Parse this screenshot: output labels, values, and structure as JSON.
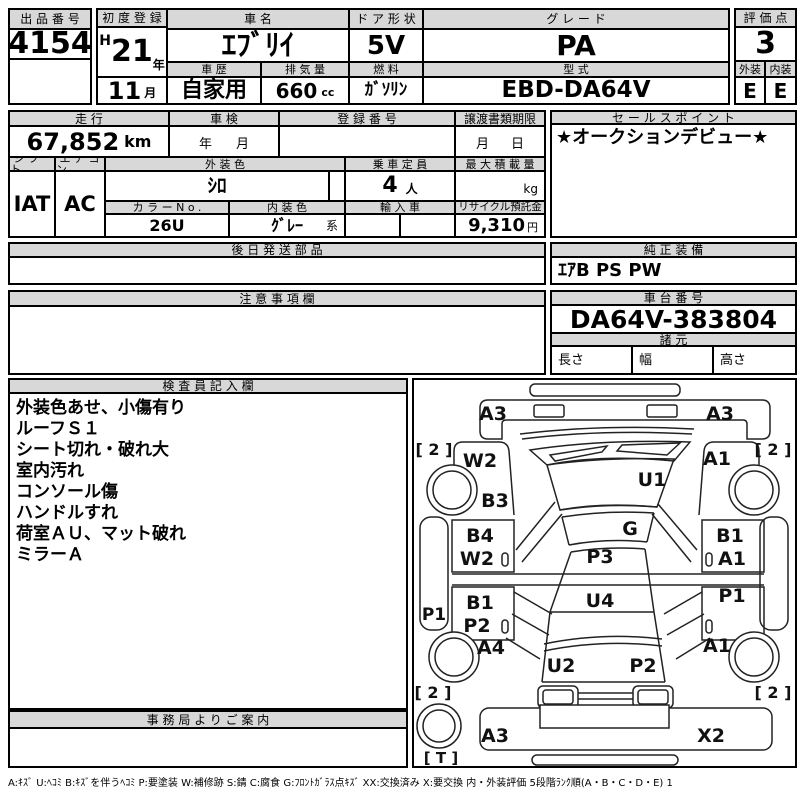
{
  "lot": {
    "label": "出品番号",
    "value": "4154"
  },
  "first_reg": {
    "label": "初度登録",
    "era": "H",
    "year": "21",
    "year_unit": "年",
    "month": "11",
    "month_unit": "月"
  },
  "car_name": {
    "label": "車名",
    "value": "ｴﾌﾞﾘｲ"
  },
  "door": {
    "label": "ドア形状",
    "value": "5V"
  },
  "grade": {
    "label": "グレード",
    "value": "PA"
  },
  "score": {
    "label": "評価点",
    "value": "3",
    "exterior_label": "外装",
    "exterior": "E",
    "interior_label": "内装",
    "interior": "E"
  },
  "history": {
    "label": "車歴",
    "value": "自家用"
  },
  "displacement": {
    "label": "排気量",
    "value": "660",
    "unit": "cc"
  },
  "fuel": {
    "label": "燃料",
    "value": "ｶﾞｿﾘﾝ"
  },
  "model_code": {
    "label": "型式",
    "value": "EBD-DA64V"
  },
  "mileage": {
    "label": "走行",
    "value": "67,852",
    "unit": "km"
  },
  "shaken": {
    "label": "車検",
    "year_unit": "年",
    "month_unit": "月"
  },
  "registration_no": {
    "label": "登録番号"
  },
  "transfer_deadline": {
    "label": "譲渡書類期限",
    "month_unit": "月",
    "day_unit": "日"
  },
  "sales_point": {
    "label": "セールスポイント",
    "value": "★オークションデビュー★"
  },
  "shift": {
    "label": "シフト",
    "value": "IAT"
  },
  "aircon": {
    "label": "エアコン",
    "value": "AC"
  },
  "exterior_color": {
    "label": "外装色",
    "value": "ｼﾛ"
  },
  "capacity": {
    "label": "乗車定員",
    "value": "4",
    "unit": "人"
  },
  "max_load": {
    "label": "最大積載量",
    "unit": "kg"
  },
  "color_no": {
    "label": "カラーNo.",
    "value": "26U"
  },
  "interior_color": {
    "label": "内装色",
    "value": "ｸﾞﾚｰ",
    "suffix": "系"
  },
  "import_car": {
    "label": "輸入車"
  },
  "recycle_deposit": {
    "label": "リサイクル預託金",
    "value": "9,310",
    "unit": "円"
  },
  "later_parts": {
    "label": "後日発送部品"
  },
  "oem_equipment": {
    "label": "純正装備",
    "value": "ｴｱB PS PW"
  },
  "notice": {
    "label": "注意事項欄"
  },
  "chassis_no": {
    "label": "車台番号",
    "value": "DA64V-383804"
  },
  "specs": {
    "label": "諸元",
    "length_label": "長さ",
    "width_label": "幅",
    "height_label": "高さ"
  },
  "inspector": {
    "label": "検査員記入欄",
    "notes": [
      "外装色あせ、小傷有り",
      "ルーフＳ１",
      "シート切れ・破れ大",
      "室内汚れ",
      "コンソール傷",
      "ハンドルすれ",
      "荷室ＡＵ、マット破れ",
      "ミラーＡ"
    ]
  },
  "office": {
    "label": "事務局よりご案内"
  },
  "legend": "A:ｷｽﾞ U:ﾍｺﾐ B:ｷｽﾞを伴うﾍｺﾐ P:要塗装 W:補修跡 S:錆 C:腐食 G:ﾌﾛﾝﾄｶﾞﾗｽ点ｷｽﾞ XX:交換済み X:要交換  内・外装評価 5段階ﾗﾝｸ順(A・B・C・D・E) 1",
  "diagram": {
    "front_bumper_left": "A3",
    "front_bumper_right": "A3",
    "fender_left": "W2",
    "fender_right": "A1",
    "tire_front_left": "[ 2 ]",
    "tire_front_right": "[ 2 ]",
    "pillar_left": "B3",
    "windshield_upper": "U1",
    "windshield": "G",
    "roof_front": "P3",
    "roof_rear": "U4",
    "door_front_left_1": "B4",
    "door_front_left_2": "W2",
    "door_front_right_1": "B1",
    "door_front_right_2": "A1",
    "rocker_left": "P1",
    "door_slide_left_1": "B1",
    "door_slide_left_2": "P2",
    "door_slide_right": "P1",
    "quarter_left": "A4",
    "quarter_right": "A1",
    "tailgate_left": "U2",
    "tailgate_right": "P2",
    "tire_rear_left": "[ 2 ]",
    "tire_rear_right": "[ 2 ]",
    "rear_bumper_left": "A3",
    "rear_bumper_right": "X2",
    "spare_tire": "[ T ]"
  }
}
